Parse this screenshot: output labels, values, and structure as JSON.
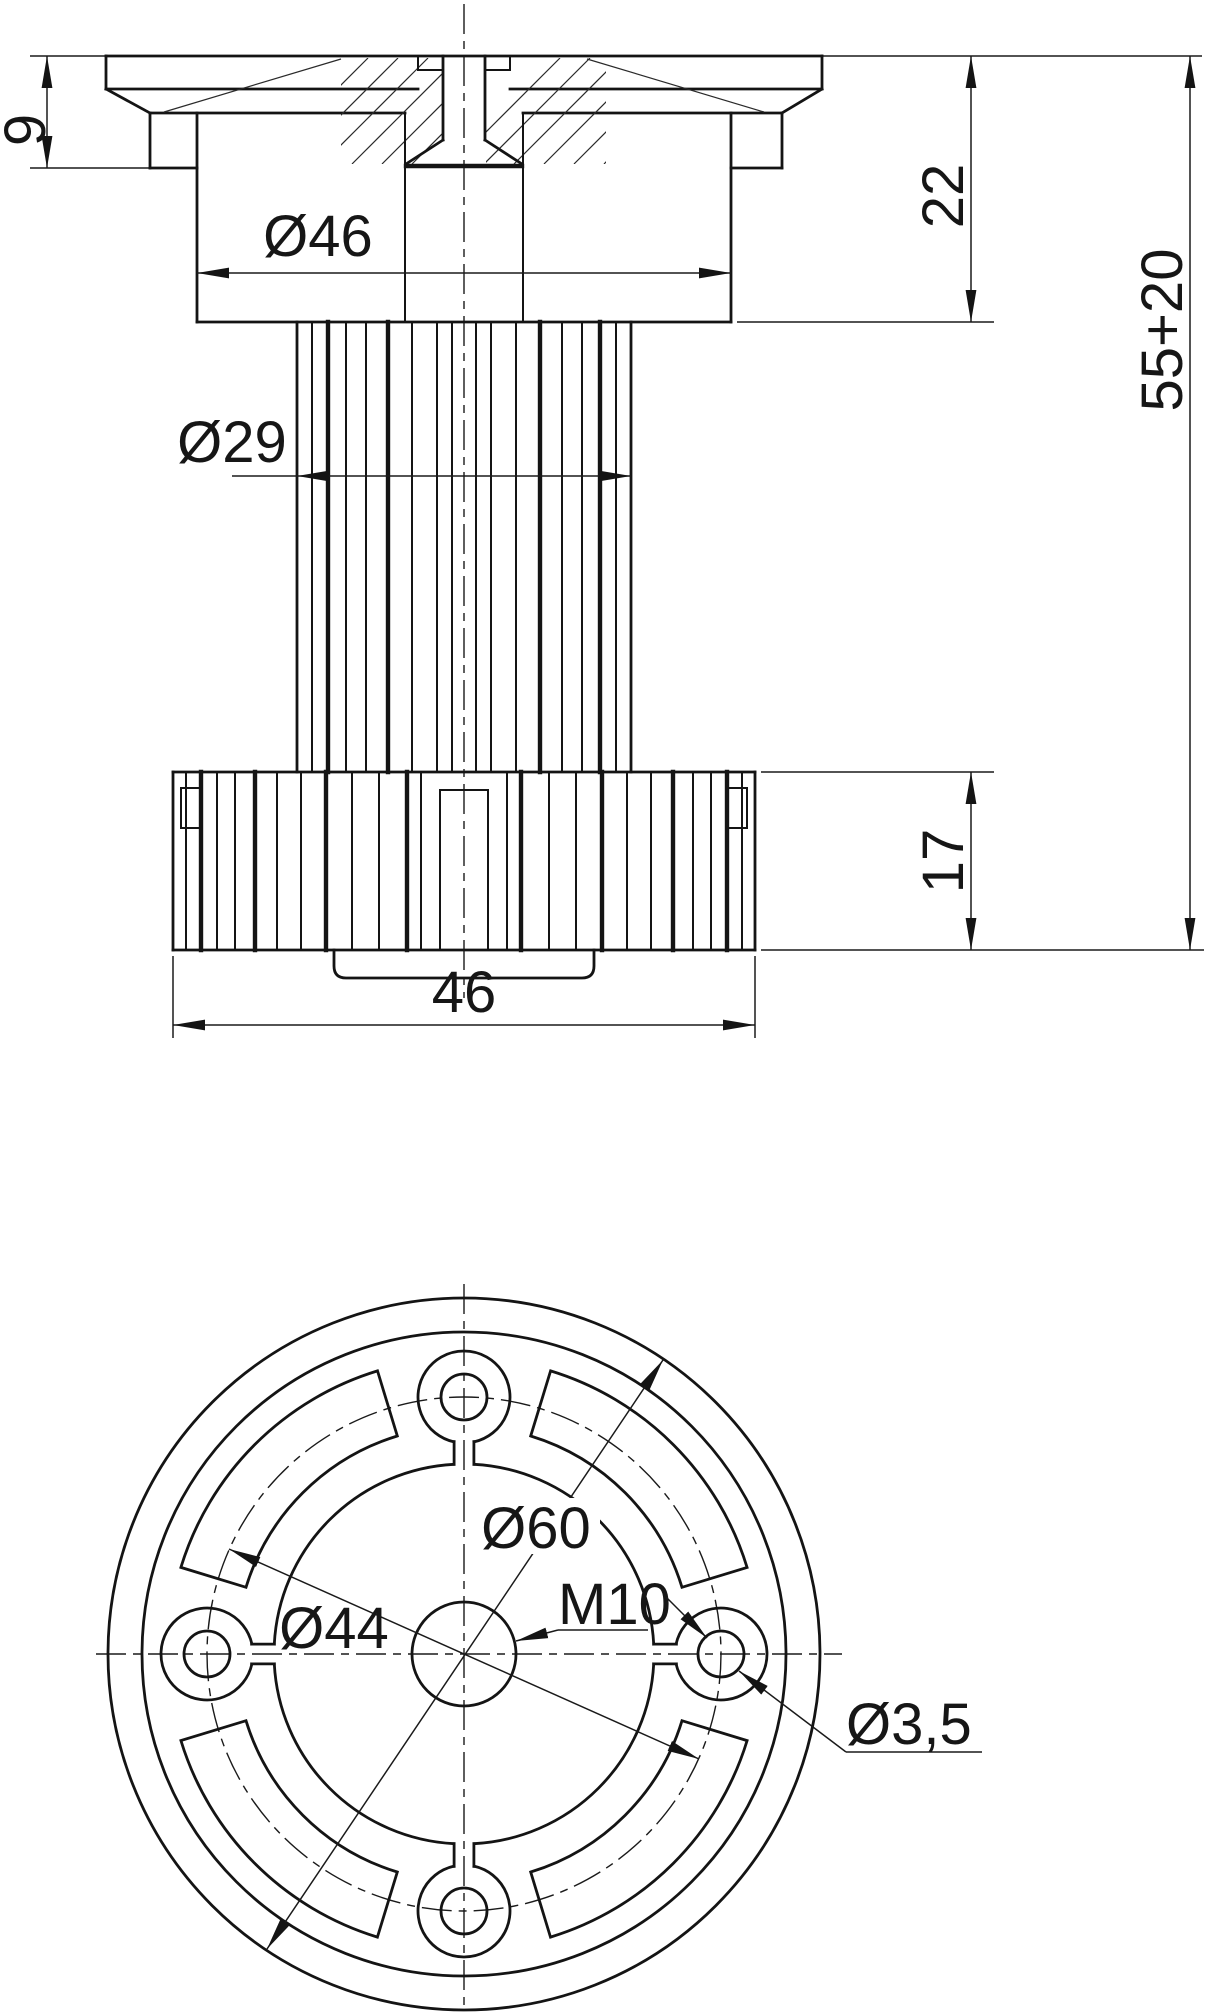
{
  "drawing": {
    "title": "adjustable-cabinet-leg-technical-drawing",
    "colors": {
      "line": "#141414",
      "background": "#ffffff"
    },
    "front_view": {
      "dims": {
        "plate_thickness": "9",
        "housing_diameter": "Ø46",
        "housing_height": "22",
        "total_height": "55+20",
        "column_diameter": "Ø29",
        "flange_height": "17",
        "flange_width": "46"
      }
    },
    "bottom_view": {
      "dims": {
        "outer_diameter": "Ø60",
        "bolt_circle_diameter": "Ø44",
        "thread": "M10",
        "screw_hole_diameter": "Ø3,5"
      }
    }
  }
}
